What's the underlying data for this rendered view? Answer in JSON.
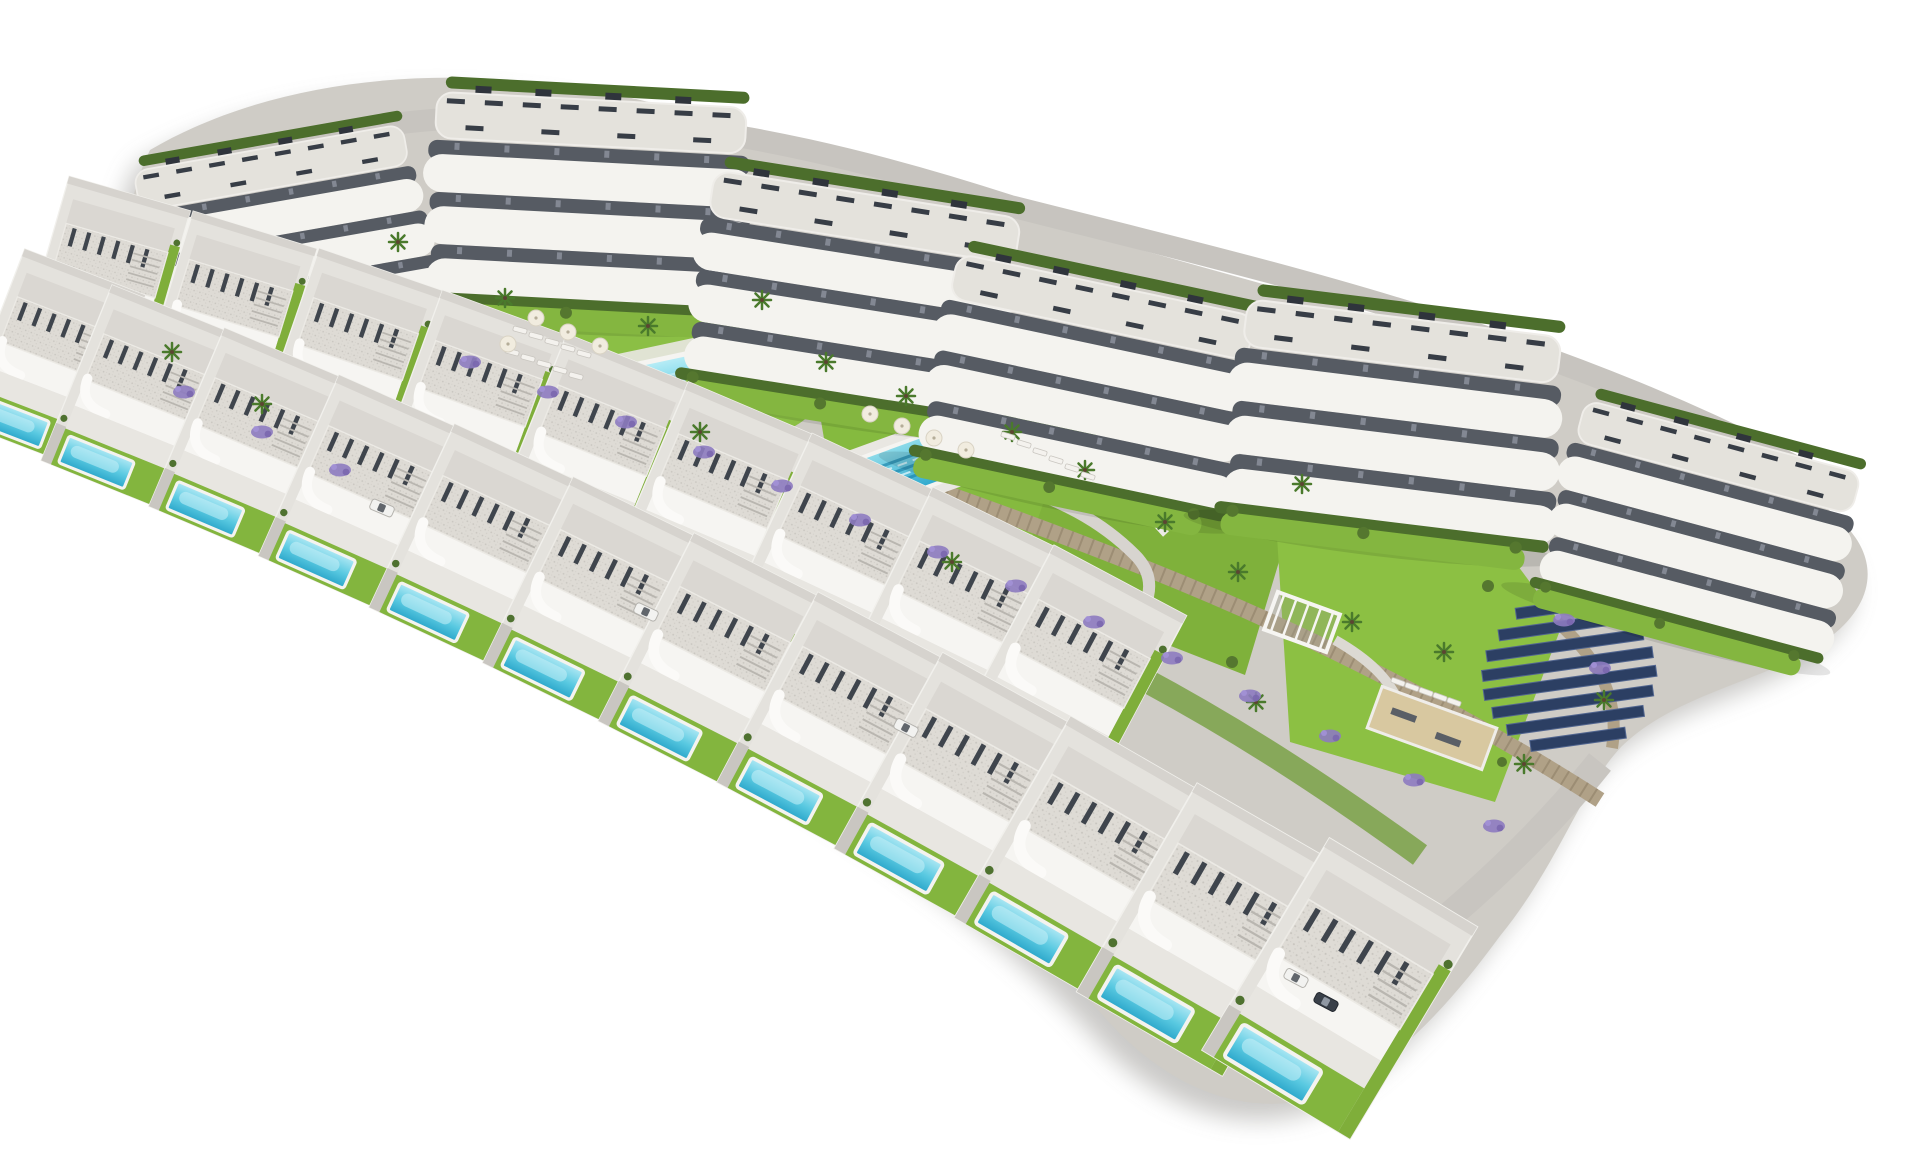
{
  "scene": {
    "description": "Aerial 3D architectural rendering of a hillside residential resort development on a white background: six curved white apartment blocks with terraced balconies along the top, two curved rows of modern villas each with a private turquoise pool, two communal pools with sun loungers and parasols, lawns, palm trees, stone retaining walls with lavender, a playground plaza, a pergola and petanque lawn, and a solar panel array",
    "background": "#ffffff"
  },
  "palette": {
    "building_white": "#f4f3ef",
    "roof_gravel": "#dedbd5",
    "pergola_dark": "#3c424b",
    "balcony_recess": "#565b63",
    "hedge_green": "#4c6e2c",
    "lawn_green": "#84b640",
    "lawn_bright": "#8cc63f",
    "palm_green": "#4a7a2c",
    "stone_wall": "#b0a187",
    "stone_wall_dark": "#8f8168",
    "path_gray": "#c9c6c1",
    "plaza_gray": "#a5a2a2",
    "pool_light": "#aee8f4",
    "pool_mid": "#59c9e1",
    "pool_deep": "#2ba6ca",
    "solar_blue": "#2c3f63",
    "solar_edge": "#51658f",
    "lavender": "#8d7bc0",
    "sand": "#d8c8a0",
    "site_shadow": "#7c7975"
  },
  "inventory": {
    "counts": {
      "apartment_blocks": 6,
      "villas": 21,
      "communal_pools": 2,
      "villa_pools": 21,
      "solar_rows": 8
    },
    "apartment_blocks": [
      {
        "x": 287,
        "y": 232,
        "rot": -10,
        "s": 0.88
      },
      {
        "x": 592,
        "y": 198,
        "rot": 3,
        "s": 1.0
      },
      {
        "x": 858,
        "y": 292,
        "rot": 9,
        "s": 1.0
      },
      {
        "x": 1092,
        "y": 380,
        "rot": 12,
        "s": 0.98
      },
      {
        "x": 1398,
        "y": 418,
        "rot": 7,
        "s": 1.02
      },
      {
        "x": 1705,
        "y": 525,
        "rot": 15,
        "s": 0.92
      }
    ],
    "villas_inner": [
      {
        "x": 105,
        "y": 280,
        "rot": 16,
        "s": 0.84
      },
      {
        "x": 228,
        "y": 318,
        "rot": 17,
        "s": 0.86
      },
      {
        "x": 351,
        "y": 359,
        "rot": 19,
        "s": 0.88
      },
      {
        "x": 473,
        "y": 404,
        "rot": 20,
        "s": 0.9
      },
      {
        "x": 594,
        "y": 451,
        "rot": 22,
        "s": 0.92
      },
      {
        "x": 714,
        "y": 502,
        "rot": 23,
        "s": 0.94
      },
      {
        "x": 834,
        "y": 557,
        "rot": 25,
        "s": 0.96
      },
      {
        "x": 953,
        "y": 614,
        "rot": 26,
        "s": 0.98
      },
      {
        "x": 1070,
        "y": 675,
        "rot": 28,
        "s": 1.0
      }
    ],
    "villas_outer": [
      {
        "x": 52,
        "y": 358,
        "rot": 21,
        "s": 0.86
      },
      {
        "x": 138,
        "y": 397,
        "rot": 22,
        "s": 0.88
      },
      {
        "x": 249,
        "y": 443,
        "rot": 23,
        "s": 0.9
      },
      {
        "x": 362,
        "y": 493,
        "rot": 24,
        "s": 0.92
      },
      {
        "x": 476,
        "y": 545,
        "rot": 25,
        "s": 0.94
      },
      {
        "x": 593,
        "y": 601,
        "rot": 26,
        "s": 0.96
      },
      {
        "x": 712,
        "y": 660,
        "rot": 27,
        "s": 0.98
      },
      {
        "x": 834,
        "y": 722,
        "rot": 28,
        "s": 1.0
      },
      {
        "x": 957,
        "y": 788,
        "rot": 29,
        "s": 1.04
      },
      {
        "x": 1083,
        "y": 857,
        "rot": 30,
        "s": 1.08
      },
      {
        "x": 1210,
        "y": 929,
        "rot": 30,
        "s": 1.12
      },
      {
        "x": 1340,
        "y": 988,
        "rot": 31,
        "s": 1.15
      }
    ],
    "palm_trees": [
      {
        "x": 398,
        "y": 242
      },
      {
        "x": 505,
        "y": 298
      },
      {
        "x": 648,
        "y": 326
      },
      {
        "x": 762,
        "y": 300
      },
      {
        "x": 700,
        "y": 432
      },
      {
        "x": 826,
        "y": 362
      },
      {
        "x": 906,
        "y": 396
      },
      {
        "x": 1012,
        "y": 432
      },
      {
        "x": 1085,
        "y": 470
      },
      {
        "x": 1165,
        "y": 522
      },
      {
        "x": 1238,
        "y": 572
      },
      {
        "x": 1302,
        "y": 484
      },
      {
        "x": 1352,
        "y": 622
      },
      {
        "x": 1444,
        "y": 652
      },
      {
        "x": 1524,
        "y": 764
      },
      {
        "x": 1604,
        "y": 700
      },
      {
        "x": 172,
        "y": 352
      },
      {
        "x": 262,
        "y": 404
      },
      {
        "x": 952,
        "y": 562
      },
      {
        "x": 1256,
        "y": 702
      }
    ],
    "sun_loungers": [
      {
        "x": 520,
        "y": 330,
        "rot": 15
      },
      {
        "x": 536,
        "y": 336,
        "rot": 15
      },
      {
        "x": 552,
        "y": 342,
        "rot": 15
      },
      {
        "x": 568,
        "y": 348,
        "rot": 15
      },
      {
        "x": 584,
        "y": 354,
        "rot": 15
      },
      {
        "x": 512,
        "y": 352,
        "rot": 15
      },
      {
        "x": 528,
        "y": 358,
        "rot": 15
      },
      {
        "x": 544,
        "y": 364,
        "rot": 15
      },
      {
        "x": 560,
        "y": 370,
        "rot": 15
      },
      {
        "x": 576,
        "y": 376,
        "rot": 15
      },
      {
        "x": 1008,
        "y": 436,
        "rot": 17
      },
      {
        "x": 1024,
        "y": 444,
        "rot": 17
      },
      {
        "x": 1040,
        "y": 452,
        "rot": 17
      },
      {
        "x": 1056,
        "y": 460,
        "rot": 17
      },
      {
        "x": 1072,
        "y": 468,
        "rot": 17
      },
      {
        "x": 1088,
        "y": 476,
        "rot": 17
      },
      {
        "x": 1398,
        "y": 682,
        "rot": 20
      },
      {
        "x": 1412,
        "y": 687,
        "rot": 20
      },
      {
        "x": 1426,
        "y": 692,
        "rot": 20
      },
      {
        "x": 1440,
        "y": 697,
        "rot": 20
      },
      {
        "x": 1454,
        "y": 702,
        "rot": 20
      }
    ],
    "parasols": [
      {
        "x": 536,
        "y": 318
      },
      {
        "x": 568,
        "y": 332
      },
      {
        "x": 600,
        "y": 346
      },
      {
        "x": 508,
        "y": 344
      },
      {
        "x": 870,
        "y": 414
      },
      {
        "x": 902,
        "y": 426
      },
      {
        "x": 934,
        "y": 438
      },
      {
        "x": 966,
        "y": 450
      }
    ],
    "lavender_patches": [
      {
        "x": 470,
        "y": 362
      },
      {
        "x": 548,
        "y": 392
      },
      {
        "x": 626,
        "y": 422
      },
      {
        "x": 704,
        "y": 452
      },
      {
        "x": 782,
        "y": 486
      },
      {
        "x": 860,
        "y": 520
      },
      {
        "x": 938,
        "y": 552
      },
      {
        "x": 1016,
        "y": 586
      },
      {
        "x": 1094,
        "y": 622
      },
      {
        "x": 1172,
        "y": 658
      },
      {
        "x": 1250,
        "y": 696
      },
      {
        "x": 1330,
        "y": 736
      },
      {
        "x": 1414,
        "y": 780
      },
      {
        "x": 1494,
        "y": 826
      },
      {
        "x": 184,
        "y": 392
      },
      {
        "x": 262,
        "y": 432
      },
      {
        "x": 340,
        "y": 470
      },
      {
        "x": 1564,
        "y": 620
      },
      {
        "x": 1600,
        "y": 668
      }
    ],
    "cars": [
      {
        "x": 382,
        "y": 508,
        "rot": 23,
        "tone": "light"
      },
      {
        "x": 646,
        "y": 612,
        "rot": 25,
        "tone": "light"
      },
      {
        "x": 906,
        "y": 728,
        "rot": 27,
        "tone": "light"
      },
      {
        "x": 1296,
        "y": 978,
        "rot": 28,
        "tone": "light"
      },
      {
        "x": 1326,
        "y": 1002,
        "rot": 28,
        "tone": "dark"
      }
    ],
    "solar_array": {
      "x": 1568,
      "y": 668,
      "rot": -8,
      "row_gap": 19,
      "row_height": 11,
      "rows": [
        88,
        128,
        158,
        172,
        174,
        162,
        138,
        96
      ]
    }
  }
}
